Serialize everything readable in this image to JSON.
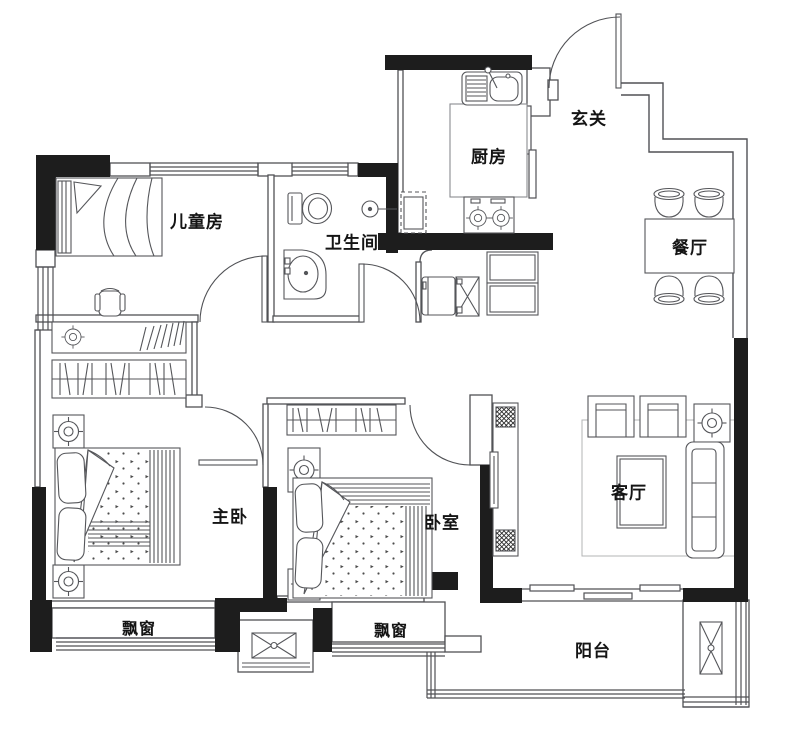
{
  "colors": {
    "wall": "#1d1d1d",
    "line": "#55565a",
    "light_line": "#8a8b8f",
    "background": "#ffffff"
  },
  "rooms": {
    "children_room": {
      "label": "儿童房"
    },
    "bathroom": {
      "label": "卫生间"
    },
    "kitchen": {
      "label": "厨房"
    },
    "entry": {
      "label": "玄关"
    },
    "dining_room": {
      "label": "餐厅"
    },
    "master_bedroom": {
      "label": "主卧"
    },
    "bedroom": {
      "label": "卧室"
    },
    "living_room": {
      "label": "客厅"
    },
    "bay_window_left": {
      "label": "飘窗"
    },
    "bay_window_right": {
      "label": "飘窗"
    },
    "balcony": {
      "label": "阳台"
    }
  }
}
